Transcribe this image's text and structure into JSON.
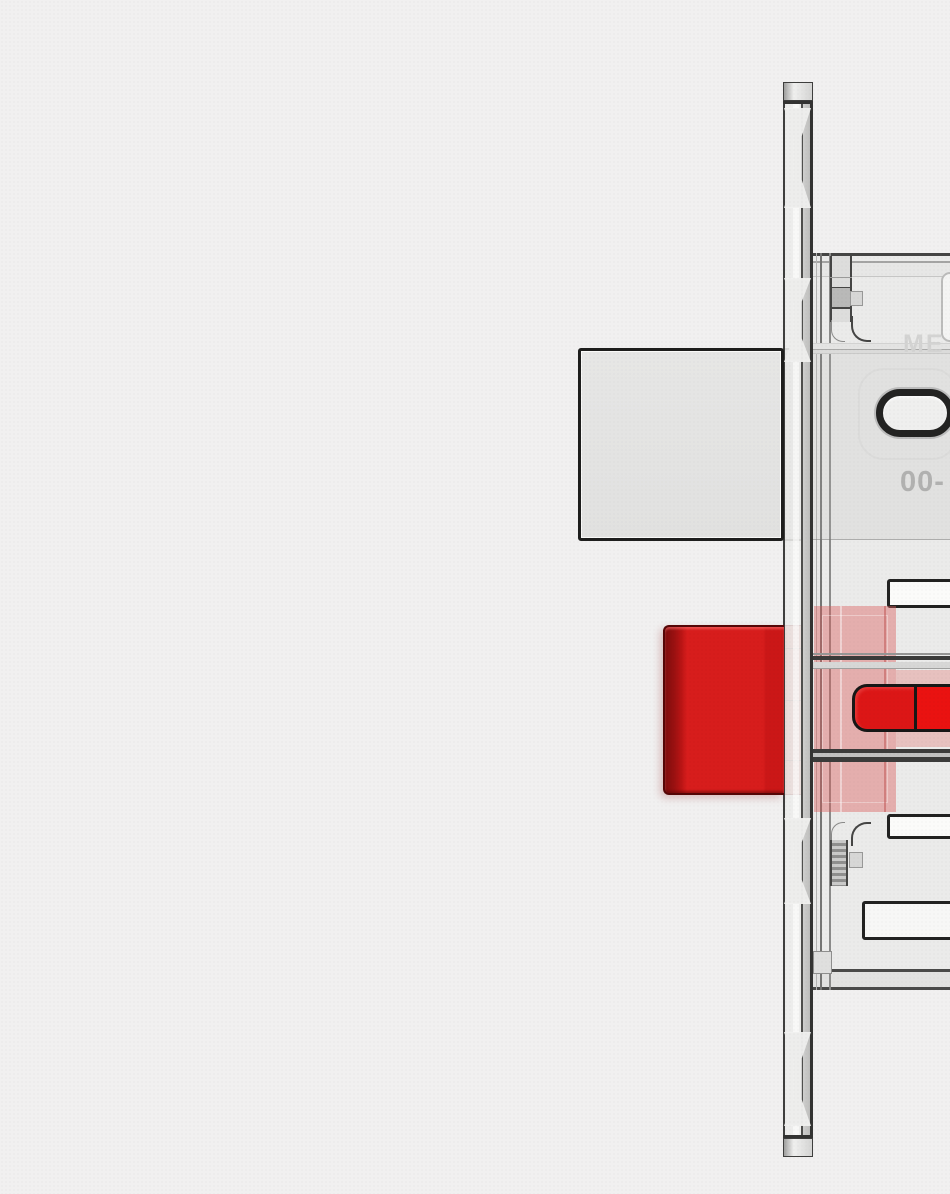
{
  "scene": {
    "background_color": "#f1f0f0",
    "view": "side cutaway render of a mortise lock body mounted behind a faceplate"
  },
  "case_markings": {
    "brand_text": "ME",
    "model_text": "00-"
  },
  "colors": {
    "latch_highlight_red": "#d71d1c",
    "latch_red_dark_edge": "#7e0c0c",
    "latch_cam_red": "#dc1616",
    "latch_cam_red_bright": "#ea1211",
    "latch_ghost_red": "rgba(219,90,89,0.42)",
    "deadbolt_gray": "#e2e2e1",
    "case_gray": "#ebebea",
    "faceplate_gray": "#ececeb",
    "outline_dark": "#1e1e1d",
    "embossed_text_gray": "#b1b1b0"
  }
}
